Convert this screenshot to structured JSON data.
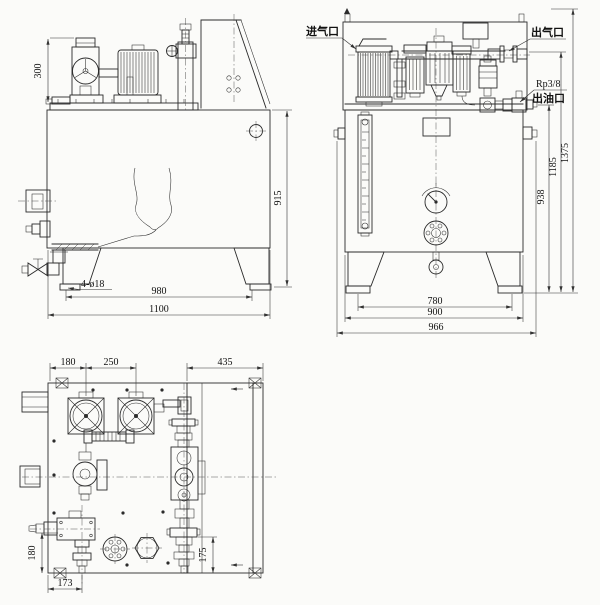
{
  "drawing": {
    "background": "#fbfbf9",
    "ink": "#2b2b2b",
    "side_view": {
      "dim_pump_height": "300",
      "dim_tank_height": "915",
      "label_mounting_holes": "4-ø18",
      "dim_foot_span": "980",
      "dim_overall_length": "1100"
    },
    "front_view": {
      "label_air_inlet": "进气口",
      "label_air_outlet": "出气口",
      "label_oil_thread": "Rp3/8",
      "label_oil_outlet": "出油口",
      "dim_oil_outlet_height": "938",
      "dim_air_outlet_height": "1185",
      "dim_overall_height": "1375",
      "dim_foot_span": "780",
      "dim_tank_width": "900",
      "dim_overall_width": "966"
    },
    "plan_view": {
      "dim_edge_to_motor": "180",
      "dim_motor_spacing": "250",
      "dim_right_cover_width": "435",
      "dim_valve_drop": "180",
      "dim_valve_offset": "173",
      "dim_manifold_drop": "175"
    }
  }
}
